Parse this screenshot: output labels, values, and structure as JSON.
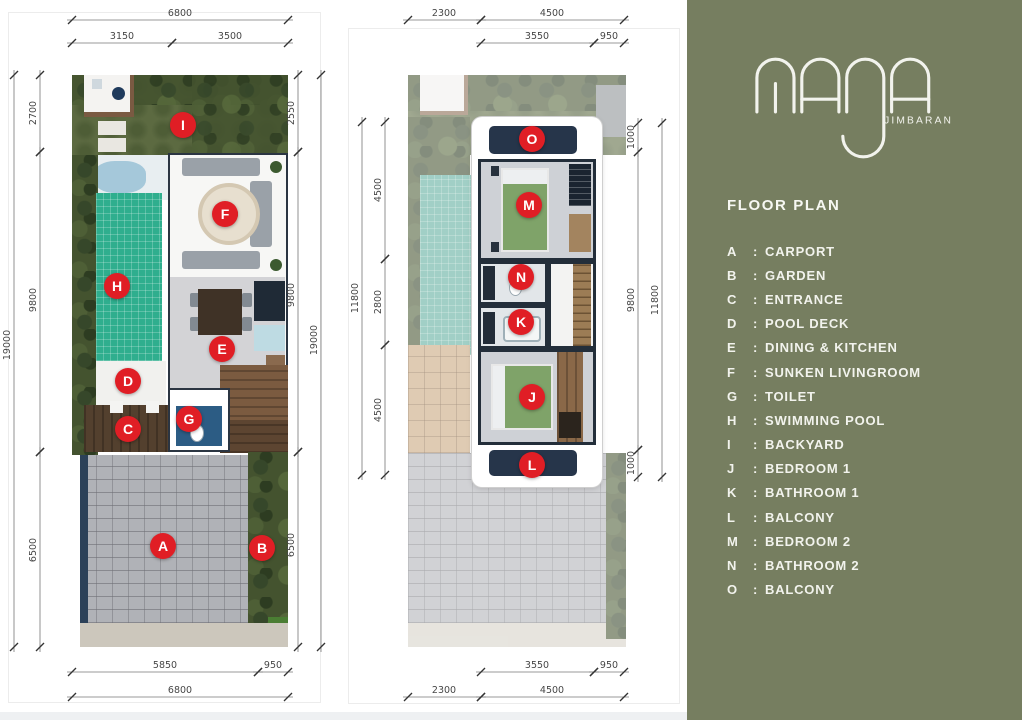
{
  "brand": {
    "name": "MAJA",
    "location": "JIMBARAN"
  },
  "theme": {
    "panel_bg": "#767E60",
    "marker_color": "#E01E25",
    "dim_color": "#474747"
  },
  "panel": {
    "title": "FLOOR PLAN",
    "separator": ":",
    "legend": [
      {
        "letter": "A",
        "name": "CARPORT"
      },
      {
        "letter": "B",
        "name": "GARDEN"
      },
      {
        "letter": "C",
        "name": "ENTRANCE"
      },
      {
        "letter": "D",
        "name": "POOL DECK"
      },
      {
        "letter": "E",
        "name": "DINING & KITCHEN"
      },
      {
        "letter": "F",
        "name": "SUNKEN LIVINGROOM"
      },
      {
        "letter": "G",
        "name": "TOILET"
      },
      {
        "letter": "H",
        "name": "SWIMMING POOL"
      },
      {
        "letter": "I",
        "name": "BACKYARD"
      },
      {
        "letter": "J",
        "name": "BEDROOM 1"
      },
      {
        "letter": "K",
        "name": "BATHROOM 1"
      },
      {
        "letter": "L",
        "name": "BALCONY"
      },
      {
        "letter": "M",
        "name": "BEDROOM 2"
      },
      {
        "letter": "N",
        "name": "BATHROOM 2"
      },
      {
        "letter": "O",
        "name": "BALCONY"
      }
    ]
  },
  "plans": [
    {
      "id": "ground-floor-plan",
      "scene": "plan1-scene",
      "markers": [
        {
          "letter": "I",
          "x": 111,
          "y": 50
        },
        {
          "letter": "F",
          "x": 153,
          "y": 139
        },
        {
          "letter": "H",
          "x": 45,
          "y": 211
        },
        {
          "letter": "E",
          "x": 150,
          "y": 274
        },
        {
          "letter": "D",
          "x": 56,
          "y": 306
        },
        {
          "letter": "C",
          "x": 56,
          "y": 354
        },
        {
          "letter": "G",
          "x": 117,
          "y": 344
        },
        {
          "letter": "A",
          "x": 91,
          "y": 471
        },
        {
          "letter": "B",
          "x": 190,
          "y": 473
        }
      ],
      "dims": [
        {
          "v": "6800",
          "x1": 72,
          "y1": 20,
          "x2": 288,
          "y2": 20,
          "lx": 180,
          "ly": 16,
          "rot": 0
        },
        {
          "v": "3150",
          "x1": 72,
          "y1": 43,
          "x2": 172,
          "y2": 43,
          "lx": 122,
          "ly": 39,
          "rot": 0
        },
        {
          "v": "3500",
          "x1": 172,
          "y1": 43,
          "x2": 288,
          "y2": 43,
          "lx": 230,
          "ly": 39,
          "rot": 0
        },
        {
          "v": "19000",
          "x1": 14,
          "y1": 75,
          "x2": 14,
          "y2": 647,
          "lx": 10,
          "ly": 345,
          "rot": -90
        },
        {
          "v": "2700",
          "x1": 40,
          "y1": 75,
          "x2": 40,
          "y2": 152,
          "lx": 36,
          "ly": 113,
          "rot": -90
        },
        {
          "v": "9800",
          "x1": 40,
          "y1": 152,
          "x2": 40,
          "y2": 452,
          "lx": 36,
          "ly": 300,
          "rot": -90
        },
        {
          "v": "6500",
          "x1": 40,
          "y1": 452,
          "x2": 40,
          "y2": 647,
          "lx": 36,
          "ly": 550,
          "rot": -90
        },
        {
          "v": "2550",
          "x1": 298,
          "y1": 75,
          "x2": 298,
          "y2": 152,
          "lx": 294,
          "ly": 113,
          "rot": -90
        },
        {
          "v": "9800",
          "x1": 298,
          "y1": 152,
          "x2": 298,
          "y2": 452,
          "lx": 294,
          "ly": 295,
          "rot": -90
        },
        {
          "v": "6500",
          "x1": 298,
          "y1": 452,
          "x2": 298,
          "y2": 647,
          "lx": 294,
          "ly": 545,
          "rot": -90
        },
        {
          "v": "19000",
          "x1": 321,
          "y1": 75,
          "x2": 321,
          "y2": 647,
          "lx": 317,
          "ly": 340,
          "rot": -90
        },
        {
          "v": "5850",
          "x1": 72,
          "y1": 672,
          "x2": 258,
          "y2": 672,
          "lx": 165,
          "ly": 668,
          "rot": 0
        },
        {
          "v": "950",
          "x1": 258,
          "y1": 672,
          "x2": 288,
          "y2": 672,
          "lx": 273,
          "ly": 668,
          "rot": 0
        },
        {
          "v": "6800",
          "x1": 72,
          "y1": 697,
          "x2": 288,
          "y2": 697,
          "lx": 180,
          "ly": 693,
          "rot": 0
        }
      ]
    },
    {
      "id": "upper-floor-plan",
      "scene": "plan2-scene",
      "markers": [
        {
          "letter": "O",
          "x": 124,
          "y": 64
        },
        {
          "letter": "M",
          "x": 121,
          "y": 130
        },
        {
          "letter": "N",
          "x": 113,
          "y": 202
        },
        {
          "letter": "K",
          "x": 113,
          "y": 247
        },
        {
          "letter": "J",
          "x": 124,
          "y": 322
        },
        {
          "letter": "L",
          "x": 124,
          "y": 390
        }
      ],
      "dims": [
        {
          "v": "2300",
          "x1": 408,
          "y1": 20,
          "x2": 481,
          "y2": 20,
          "lx": 444,
          "ly": 16,
          "rot": 0
        },
        {
          "v": "4500",
          "x1": 481,
          "y1": 20,
          "x2": 624,
          "y2": 20,
          "lx": 552,
          "ly": 16,
          "rot": 0
        },
        {
          "v": "3550",
          "x1": 481,
          "y1": 43,
          "x2": 594,
          "y2": 43,
          "lx": 537,
          "ly": 39,
          "rot": 0
        },
        {
          "v": "950",
          "x1": 594,
          "y1": 43,
          "x2": 624,
          "y2": 43,
          "lx": 609,
          "ly": 39,
          "rot": 0
        },
        {
          "v": "11800",
          "x1": 362,
          "y1": 122,
          "x2": 362,
          "y2": 475,
          "lx": 358,
          "ly": 298,
          "rot": -90
        },
        {
          "v": "4500",
          "x1": 385,
          "y1": 122,
          "x2": 385,
          "y2": 259,
          "lx": 381,
          "ly": 190,
          "rot": -90
        },
        {
          "v": "2800",
          "x1": 385,
          "y1": 259,
          "x2": 385,
          "y2": 345,
          "lx": 381,
          "ly": 302,
          "rot": -90
        },
        {
          "v": "4500",
          "x1": 385,
          "y1": 345,
          "x2": 385,
          "y2": 475,
          "lx": 381,
          "ly": 410,
          "rot": -90
        },
        {
          "v": "1000",
          "x1": 638,
          "y1": 123,
          "x2": 638,
          "y2": 152,
          "lx": 634,
          "ly": 137,
          "rot": -90
        },
        {
          "v": "9800",
          "x1": 638,
          "y1": 152,
          "x2": 638,
          "y2": 450,
          "lx": 634,
          "ly": 300,
          "rot": -90
        },
        {
          "v": "1000",
          "x1": 638,
          "y1": 450,
          "x2": 638,
          "y2": 477,
          "lx": 634,
          "ly": 463,
          "rot": -90
        },
        {
          "v": "11800",
          "x1": 662,
          "y1": 123,
          "x2": 662,
          "y2": 477,
          "lx": 658,
          "ly": 300,
          "rot": -90
        },
        {
          "v": "3550",
          "x1": 481,
          "y1": 672,
          "x2": 594,
          "y2": 672,
          "lx": 537,
          "ly": 668,
          "rot": 0
        },
        {
          "v": "950",
          "x1": 594,
          "y1": 672,
          "x2": 624,
          "y2": 672,
          "lx": 609,
          "ly": 668,
          "rot": 0
        },
        {
          "v": "2300",
          "x1": 408,
          "y1": 697,
          "x2": 481,
          "y2": 697,
          "lx": 444,
          "ly": 693,
          "rot": 0
        },
        {
          "v": "4500",
          "x1": 481,
          "y1": 697,
          "x2": 624,
          "y2": 697,
          "lx": 552,
          "ly": 693,
          "rot": 0
        }
      ]
    }
  ]
}
